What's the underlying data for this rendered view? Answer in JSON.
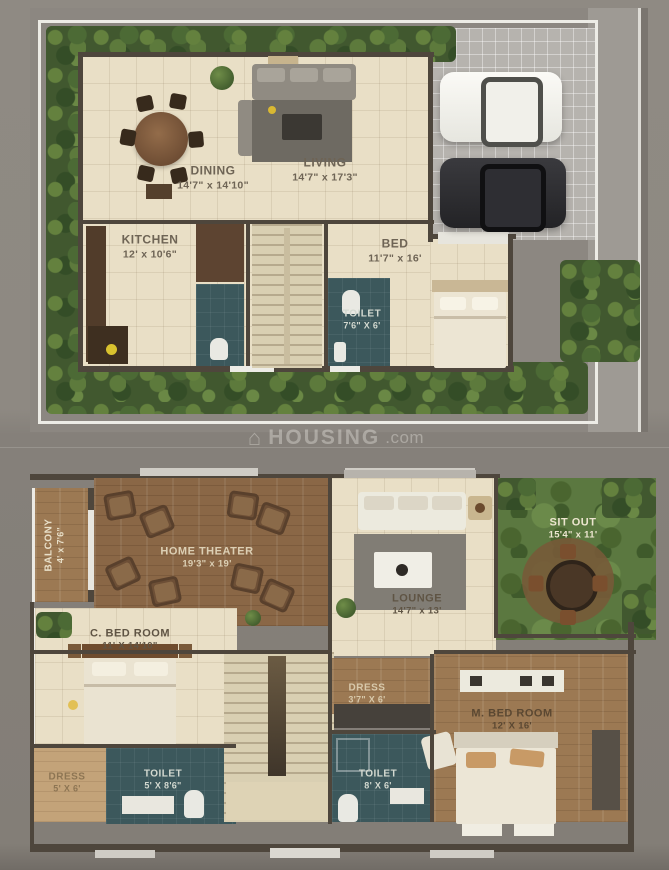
{
  "watermark": {
    "icon_glyph": "⌂",
    "brand": "HOUSING",
    "tld": ".com"
  },
  "ground_floor": {
    "dining": {
      "label": "DINING",
      "dims": "14'7\" x 14'10\""
    },
    "living": {
      "label": "LIVING",
      "dims": "14'7\" x 17'3\""
    },
    "kitchen": {
      "label": "KITCHEN",
      "dims": "12' x 10'6\""
    },
    "bed": {
      "label": "BED",
      "dims": "11'7\" x 16'"
    },
    "toilet": {
      "label": "TOILET",
      "dims": "7'6\" X 6'"
    }
  },
  "first_floor": {
    "balcony": {
      "label": "BALCONY",
      "dims": "4' x 7'6\""
    },
    "home_theater": {
      "label": "HOME THEATER",
      "dims": "19'3\" x 19'"
    },
    "lounge": {
      "label": "LOUNGE",
      "dims": "14'7\" x 13'"
    },
    "sit_out": {
      "label": "SIT OUT",
      "dims": "15'4\" x 11'"
    },
    "c_bed_room": {
      "label": "C. BED ROOM",
      "dims": "11' X 14'10\""
    },
    "dress_1": {
      "label": "DRESS",
      "dims": "5' X 6'"
    },
    "toilet_1": {
      "label": "TOILET",
      "dims": "5' X 8'6\""
    },
    "dress_2": {
      "label": "DRESS",
      "dims": "3'7\" X 6'"
    },
    "toilet_2": {
      "label": "TOILET",
      "dims": "8' X 6'"
    },
    "m_bed_room": {
      "label": "M. BED ROOM",
      "dims": "12' X 16'"
    }
  },
  "colors": {
    "hedge_green": "#41582f",
    "floor_beige": "#e9dfc6",
    "wood_floor": "#9c7953",
    "theater_wood": "#8a6746",
    "toilet_teal": "#3c585c",
    "paver_grey": "#b6b3ae",
    "wall_brown": "#4e463c",
    "car_white": "#f4f3ee",
    "car_black": "#2b2b2e",
    "sitout_green": "#5b7840",
    "label_dark": "#6e6455",
    "label_light": "#d3d9d0"
  }
}
